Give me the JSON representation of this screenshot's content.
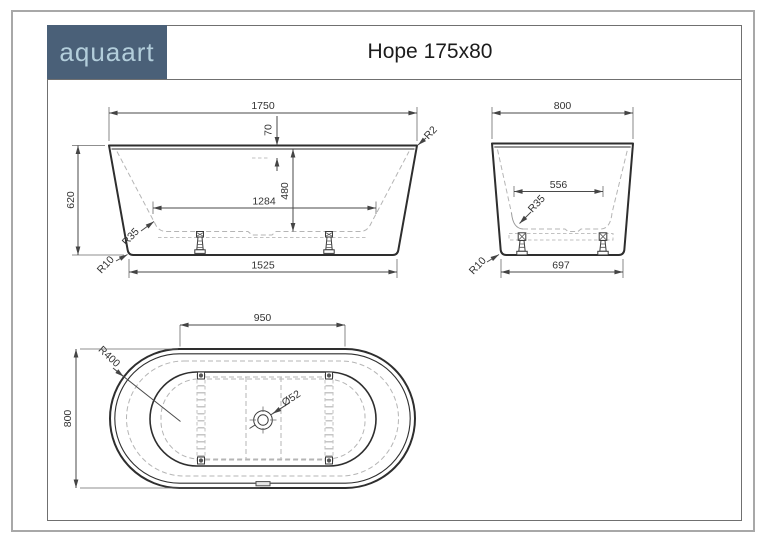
{
  "header": {
    "logo_text": "aquaart",
    "title": "Hope 175x80"
  },
  "colors": {
    "logo_bg": "#4a6078",
    "logo_text": "#b3cedb",
    "outline": "#2e2e2e",
    "hidden_line": "#b5b5b5",
    "dimension_line": "#4a4a4a"
  },
  "front": {
    "width_top": "1750",
    "overflow_offset": "70",
    "depth": "480",
    "floor_width": "1284",
    "width_bottom": "1525",
    "height": "620",
    "r_top": "R2",
    "r_inner": "R35",
    "r_bottom": "R10"
  },
  "side": {
    "width_top": "800",
    "floor_width": "556",
    "width_bottom": "697",
    "r_inner": "R35",
    "r_bottom": "R10"
  },
  "top": {
    "straight_length": "950",
    "width": "800",
    "r_end": "R400",
    "drain": "Ø52"
  }
}
